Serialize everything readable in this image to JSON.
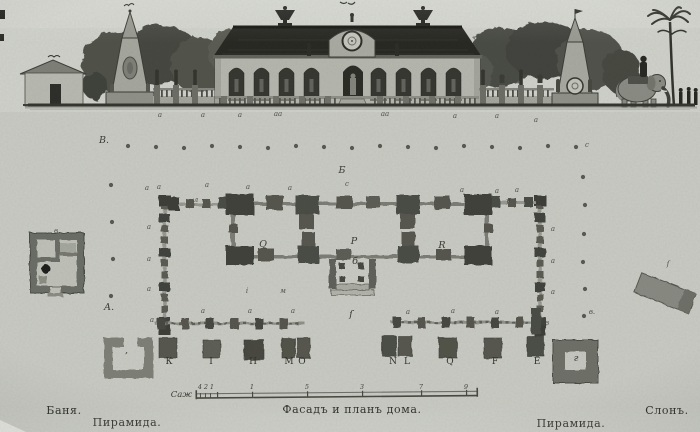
{
  "title": "Фасадъ и планъ дома.",
  "captions": {
    "bath": "Баня.",
    "pyramid_left": "Пирамида.",
    "main": "Фасадъ и планъ дома.",
    "pyramid_right": "Пирамида.",
    "elephant": "Слонъ."
  },
  "scale_bar": {
    "label": "Саж",
    "ticks": [
      {
        "t": "4",
        "x": 200
      },
      {
        "t": "2",
        "x": 206
      },
      {
        "t": "1",
        "x": 212
      },
      {
        "t": "1",
        "x": 252
      },
      {
        "t": "5",
        "x": 307
      },
      {
        "t": "3",
        "x": 362
      },
      {
        "t": "7",
        "x": 421
      },
      {
        "t": "9",
        "x": 466
      }
    ]
  },
  "plan_labels": [
    {
      "t": "В.",
      "x": 104,
      "y": 136,
      "s": "lg"
    },
    {
      "t": "А.",
      "x": 109,
      "y": 303,
      "s": "lg"
    },
    {
      "t": "с",
      "x": 587,
      "y": 142,
      "s": "sm"
    },
    {
      "t": "в.",
      "x": 592,
      "y": 309,
      "s": "sm"
    },
    {
      "t": "Б",
      "x": 342,
      "y": 166,
      "s": "lg"
    },
    {
      "t": "с",
      "x": 347,
      "y": 181,
      "s": "sm"
    },
    {
      "t": "Q",
      "x": 263,
      "y": 240,
      "s": "lg"
    },
    {
      "t": "Р",
      "x": 354,
      "y": 237,
      "s": "lg"
    },
    {
      "t": "R",
      "x": 442,
      "y": 241,
      "s": "lg"
    },
    {
      "t": "б",
      "x": 355,
      "y": 257,
      "s": "lg"
    },
    {
      "t": "ſ",
      "x": 351,
      "y": 310,
      "s": "lg"
    },
    {
      "t": "у",
      "x": 508,
      "y": 198,
      "s": "sm"
    },
    {
      "t": "л",
      "x": 196,
      "y": 197,
      "s": "sm"
    },
    {
      "t": "г",
      "x": 576,
      "y": 354,
      "s": "lg"
    },
    {
      "t": "в",
      "x": 56,
      "y": 228,
      "s": "sm"
    },
    {
      "t": "м",
      "x": 283,
      "y": 288,
      "s": "sm"
    },
    {
      "t": "і",
      "x": 247,
      "y": 288,
      "s": "sm"
    },
    {
      "t": "ʼ",
      "x": 126,
      "y": 352,
      "s": "lg"
    },
    {
      "t": "ſ",
      "x": 668,
      "y": 261,
      "s": "sm"
    },
    {
      "t": "К",
      "x": 169,
      "y": 358,
      "s": "md"
    },
    {
      "t": "I",
      "x": 211,
      "y": 358,
      "s": "md"
    },
    {
      "t": "Н",
      "x": 253,
      "y": 358,
      "s": "md"
    },
    {
      "t": "М",
      "x": 289,
      "y": 358,
      "s": "md"
    },
    {
      "t": "О",
      "x": 302,
      "y": 358,
      "s": "md"
    },
    {
      "t": "N",
      "x": 393,
      "y": 358,
      "s": "md"
    },
    {
      "t": "L",
      "x": 407,
      "y": 358,
      "s": "md"
    },
    {
      "t": "Q",
      "x": 450,
      "y": 358,
      "s": "md"
    },
    {
      "t": "F",
      "x": 495,
      "y": 358,
      "s": "md"
    },
    {
      "t": "Е",
      "x": 537,
      "y": 358,
      "s": "md"
    },
    {
      "t": "а",
      "x": 160,
      "y": 112,
      "s": "sm"
    },
    {
      "t": "а",
      "x": 203,
      "y": 112,
      "s": "sm"
    },
    {
      "t": "а",
      "x": 240,
      "y": 112,
      "s": "sm"
    },
    {
      "t": "аа",
      "x": 278,
      "y": 111,
      "s": "sm"
    },
    {
      "t": "аа",
      "x": 385,
      "y": 111,
      "s": "sm"
    },
    {
      "t": "а",
      "x": 455,
      "y": 113,
      "s": "sm"
    },
    {
      "t": "а",
      "x": 497,
      "y": 113,
      "s": "sm"
    },
    {
      "t": "а",
      "x": 536,
      "y": 117,
      "s": "sm"
    },
    {
      "t": "а",
      "x": 147,
      "y": 185,
      "s": "sm"
    },
    {
      "t": "а",
      "x": 159,
      "y": 184,
      "s": "sm"
    },
    {
      "t": "а",
      "x": 207,
      "y": 182,
      "s": "sm"
    },
    {
      "t": "а",
      "x": 248,
      "y": 184,
      "s": "sm"
    },
    {
      "t": "а",
      "x": 290,
      "y": 185,
      "s": "sm"
    },
    {
      "t": "а",
      "x": 462,
      "y": 187,
      "s": "sm"
    },
    {
      "t": "а",
      "x": 497,
      "y": 188,
      "s": "sm"
    },
    {
      "t": "а",
      "x": 517,
      "y": 187,
      "s": "sm"
    },
    {
      "t": "а",
      "x": 149,
      "y": 224,
      "s": "sm"
    },
    {
      "t": "а",
      "x": 149,
      "y": 256,
      "s": "sm"
    },
    {
      "t": "а",
      "x": 149,
      "y": 286,
      "s": "sm"
    },
    {
      "t": "а",
      "x": 553,
      "y": 226,
      "s": "sm"
    },
    {
      "t": "а",
      "x": 553,
      "y": 258,
      "s": "sm"
    },
    {
      "t": "а",
      "x": 553,
      "y": 289,
      "s": "sm"
    },
    {
      "t": "а",
      "x": 152,
      "y": 317,
      "s": "sm"
    },
    {
      "t": "а",
      "x": 203,
      "y": 308,
      "s": "sm"
    },
    {
      "t": "а",
      "x": 250,
      "y": 308,
      "s": "sm"
    },
    {
      "t": "а",
      "x": 293,
      "y": 308,
      "s": "sm"
    },
    {
      "t": "а",
      "x": 408,
      "y": 309,
      "s": "sm"
    },
    {
      "t": "а",
      "x": 453,
      "y": 308,
      "s": "sm"
    },
    {
      "t": "а",
      "x": 497,
      "y": 309,
      "s": "sm"
    },
    {
      "t": "в",
      "x": 547,
      "y": 320,
      "s": "sm"
    }
  ]
}
